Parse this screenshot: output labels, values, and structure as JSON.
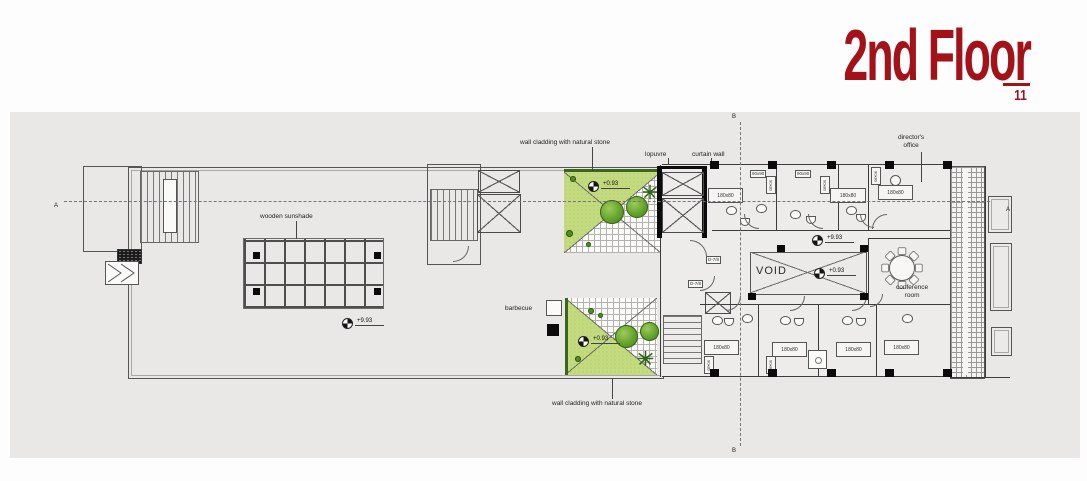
{
  "header": {
    "title": "2nd Floor",
    "page": "11"
  },
  "colors": {
    "accent": "#a31119",
    "panel_bg": "#e9e8e6",
    "garden_green": "#c3da7e"
  },
  "annotations": {
    "cladding_top": "wall cladding with natural stone",
    "cladding_bottom": "wall cladding with natural stone",
    "louvre": "lopuvre",
    "curtain_wall": "curtain wall",
    "sunshade": "wooden sunshade",
    "barbecue": "barbecue",
    "director_line1": "director's",
    "director_line2": "office",
    "conference_line1": "conference",
    "conference_line2": "room",
    "void": "VOID"
  },
  "levels": {
    "terrace": "+9.93",
    "corridor": "+9.93",
    "garden_upper": "+0.93",
    "garden_lower": "+0.93",
    "void_area": "+0.93"
  },
  "tags": {
    "bed": "180x80",
    "cabinet_a": "90x90",
    "cabinet_b": "90x80",
    "door": "D-7/8"
  },
  "sections": {
    "a": "A",
    "b": "B"
  }
}
